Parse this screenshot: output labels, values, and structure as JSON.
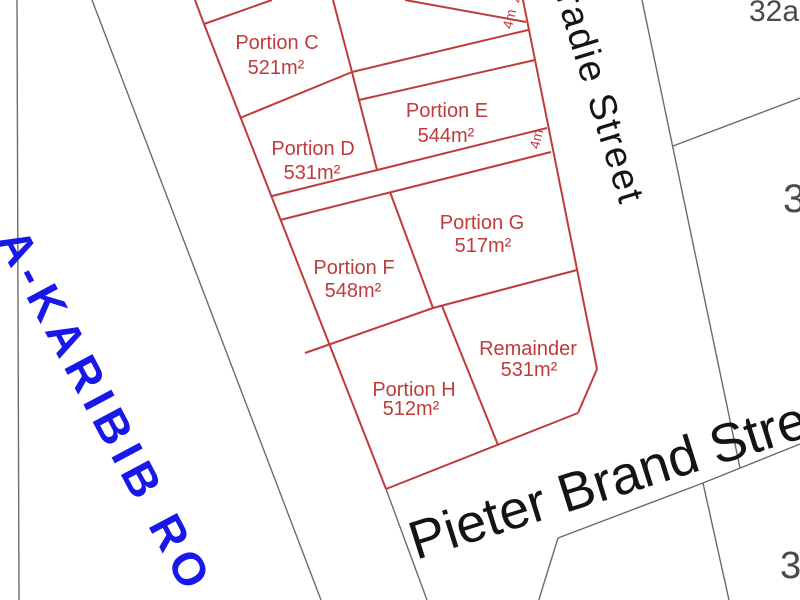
{
  "map": {
    "title": "Subdivision plan",
    "parcels": [
      {
        "name": "Portion C",
        "area": "521m²"
      },
      {
        "name": "Portion D",
        "area": "531m²"
      },
      {
        "name": "Portion E",
        "area": "544m²"
      },
      {
        "name": "Portion F",
        "area": "548m²"
      },
      {
        "name": "Portion G",
        "area": "517m²"
      },
      {
        "name": "Portion H",
        "area": "512m²"
      },
      {
        "name": "Remainder",
        "area": "531m²"
      }
    ],
    "streets": {
      "east_street": "radie Street",
      "south_street": "Pieter Brand Street"
    },
    "road": {
      "name": "A-KARIBIB RO"
    },
    "dimensions": {
      "walkway1_top": "4m",
      "walkway1": "4m",
      "walkway2": "4m"
    },
    "neighbor_numbers": {
      "top_right": "32a",
      "east": "3",
      "south_east": "3"
    },
    "colors": {
      "parcel_lines": "#c03b3b",
      "neighbor_lines": "#6b6b6b",
      "street_text": "#141414",
      "road_text": "#1818e8"
    }
  }
}
